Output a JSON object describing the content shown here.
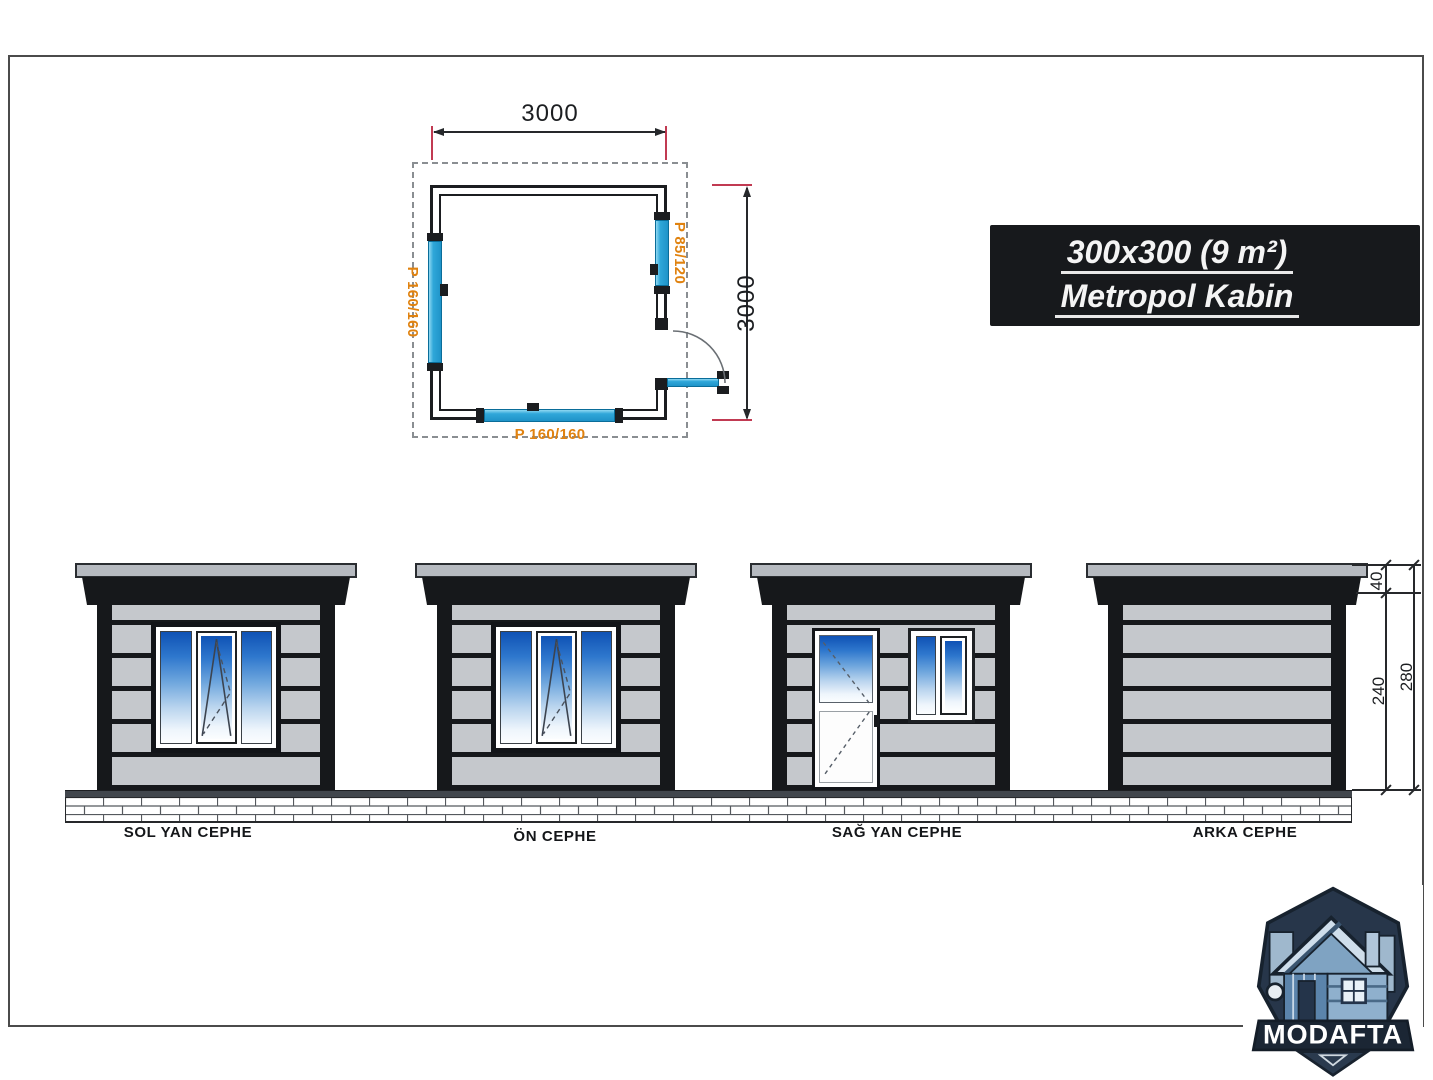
{
  "page": {
    "badge": {
      "line1": "300x300 (9 m²)",
      "line2": "Metropol Kabin"
    },
    "plan": {
      "width_dim": "3000",
      "height_dim": "3000",
      "left_window_label": "P 160/160",
      "right_window_label": "P 85/120",
      "bottom_window_label": "P 160/160"
    },
    "elevations": [
      {
        "label": "SOL YAN CEPHE"
      },
      {
        "label": "ÖN CEPHE"
      },
      {
        "label": "SAĞ YAN CEPHE"
      },
      {
        "label": "ARKA CEPHE"
      }
    ],
    "height_dims": {
      "roof": "40",
      "wall": "240",
      "total": "280"
    },
    "logo_text": "MODAFTA",
    "colors": {
      "badge_black": "#17191c",
      "accent_orange": "#e0820f",
      "plan_window_cyan": "#2fa7d9",
      "extension_red": "#c13a52",
      "glass_blue_top": "#0f52b5",
      "siding_gray": "#c5c8cc",
      "frame_black": "#16181b"
    }
  }
}
